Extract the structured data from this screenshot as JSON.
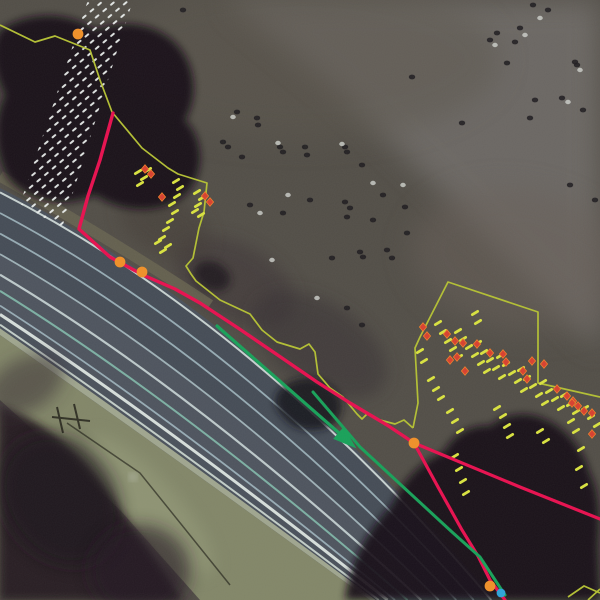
{
  "canvas": {
    "w": 600,
    "h": 600
  },
  "colors": {
    "field_base": "#524e47",
    "field_light": "#5b564e",
    "upper_right_gray": "#6e6a66",
    "mid_shadow": "#3a3134",
    "tree_dark": "#131116",
    "vegetation_dark": "#281e24",
    "road_asphalt": "#4a515b",
    "road_stripe": "#9bb0b8",
    "road_edge_white": "#dde6e2",
    "shoulder": "#828668",
    "hatch_white": "#e9edeb",
    "boundary_yellow": "#b3bf33",
    "dash_yellow": "#d9e23f",
    "route_red": "#e8104f",
    "direction_green": "#18a159",
    "marker_red": "#d8402f",
    "marker_orange": "#ef7f2a",
    "waypoint_orange": "#f09028",
    "waypoint_blue": "#2ea4d9",
    "shadow_dark": "#17150f",
    "speckle_dark": "#1d1b1e",
    "speckle_light": "#cfd2cd"
  },
  "background": {
    "regions": [
      {
        "name": "upper-right-gray-field",
        "type": "polygon",
        "points": [
          [
            225,
            0
          ],
          [
            600,
            0
          ],
          [
            600,
            350
          ],
          [
            455,
            205
          ],
          [
            335,
            90
          ]
        ],
        "fill": "#6e6a66",
        "opacity": 0.92,
        "blur": "b14"
      },
      {
        "name": "top-field-light-patch",
        "type": "ellipse",
        "cx": 300,
        "cy": 60,
        "rx": 200,
        "ry": 80,
        "rot": 0,
        "fill": "#5b564e",
        "opacity": 0.5,
        "blur": "b14"
      },
      {
        "name": "right-field-patch",
        "type": "ellipse",
        "cx": 520,
        "cy": 260,
        "rx": 110,
        "ry": 70,
        "rot": 10,
        "fill": "#675f58",
        "opacity": 0.5,
        "blur": "b14"
      },
      {
        "name": "mid-shadow-1",
        "type": "ellipse",
        "cx": 235,
        "cy": 282,
        "rx": 65,
        "ry": 38,
        "rot": 28,
        "fill": "#3b3134",
        "opacity": 0.5,
        "blur": "b8"
      },
      {
        "name": "mid-shadow-2",
        "type": "ellipse",
        "cx": 320,
        "cy": 345,
        "rx": 75,
        "ry": 42,
        "rot": 33,
        "fill": "#362d31",
        "opacity": 0.5,
        "blur": "b8"
      },
      {
        "name": "mid-shadow-3",
        "type": "ellipse",
        "cx": 165,
        "cy": 225,
        "rx": 50,
        "ry": 30,
        "rot": 30,
        "fill": "#433a36",
        "opacity": 0.45,
        "blur": "b8"
      }
    ]
  },
  "trees": [
    {
      "name": "tree-canopy-top-left",
      "d": "M0,30 C30,10 70,12 95,30 C120,20 150,22 172,40 C195,60 200,95 185,120 C205,140 205,175 185,195 C160,215 120,212 95,195 C60,210 25,200 8,178 C-5,155 -8,120 5,95 C-8,70 -10,45 0,30 Z",
      "fill": "#131116",
      "opacity": 0.92,
      "blur": "b4"
    },
    {
      "name": "tree-blob-left-mid",
      "type": "ellipse",
      "cx": 212,
      "cy": 276,
      "rx": 19,
      "ry": 14,
      "rot": 25,
      "fill": "#1a171b",
      "opacity": 0.8,
      "blur": "b4"
    },
    {
      "name": "tree-blob-center-road",
      "d": "M278,392 C288,378 312,374 326,384 C342,392 346,410 336,422 C322,434 296,432 286,420 C276,410 272,402 278,392 Z",
      "fill": "#16141a",
      "opacity": 0.85,
      "blur": "b4"
    },
    {
      "name": "tree-canopy-bottom-right",
      "d": "M345,600 C350,560 368,530 392,505 C402,482 420,462 444,452 C452,436 470,424 490,426 C504,414 528,410 546,420 C566,428 584,450 590,474 C600,492 600,520 598,545 L600,600 Z",
      "fill": "#131116",
      "opacity": 0.92,
      "blur": "b4"
    },
    {
      "name": "vegetation-bottom-left",
      "d": "M0,405 C40,420 80,448 120,510 C150,552 170,580 182,600 L0,600 Z",
      "fill": "#281e24",
      "opacity": 0.95,
      "blur": "b4"
    },
    {
      "name": "vegetation-inner-1",
      "type": "ellipse",
      "cx": 60,
      "cy": 500,
      "rx": 55,
      "ry": 70,
      "rot": -35,
      "fill": "#1c141b",
      "opacity": 0.7,
      "blur": "b8"
    },
    {
      "name": "vegetation-inner-2",
      "type": "ellipse",
      "cx": 140,
      "cy": 570,
      "rx": 50,
      "ry": 45,
      "rot": 0,
      "fill": "#201820",
      "opacity": 0.6,
      "blur": "b8"
    },
    {
      "name": "vegetation-edge-patch",
      "type": "ellipse",
      "cx": 25,
      "cy": 385,
      "rx": 42,
      "ry": 26,
      "rot": -30,
      "fill": "#352a31",
      "opacity": 0.5,
      "blur": "b8"
    }
  ],
  "road": {
    "ne_edge": [
      [
        0,
        188
      ],
      [
        260,
        320
      ],
      [
        495,
        600
      ]
    ],
    "sw_edge": [
      [
        0,
        335
      ],
      [
        150,
        440
      ],
      [
        370,
        600
      ]
    ],
    "surface_fill": "#4a515b",
    "bands": [
      {
        "f1": 0.03,
        "f2": 0.45,
        "c": "#40474f",
        "o": 0.45
      },
      {
        "f1": 0.45,
        "f2": 0.86,
        "c": "#545b64",
        "o": 0.4
      },
      {
        "f1": 0.955,
        "f2": 1.0,
        "c": "#b5bb9c",
        "o": 0.8
      }
    ],
    "stripes": [
      {
        "f": 0.03,
        "c": "#cdd8d6",
        "w": 2.0
      },
      {
        "f": 0.17,
        "c": "#9bb0b8",
        "w": 1.8
      },
      {
        "f": 0.31,
        "c": "#9bb0b8",
        "w": 1.8
      },
      {
        "f": 0.45,
        "c": "#a3b6bc",
        "w": 1.8
      },
      {
        "f": 0.59,
        "c": "#c3d0d0",
        "w": 2.2
      },
      {
        "f": 0.7,
        "c": "#7fb5a6",
        "w": 2.0
      },
      {
        "f": 0.8,
        "c": "#9bb0b8",
        "w": 1.8
      },
      {
        "f": 0.86,
        "c": "#dde6e2",
        "w": 3.0
      },
      {
        "f": 0.93,
        "c": "#c8d4ce",
        "w": 2.0
      }
    ],
    "shoulder_outer": [
      [
        200,
        600
      ],
      [
        120,
        510
      ],
      [
        0,
        400
      ]
    ],
    "shoulder_fill": "#828668",
    "shoulder_streak": {
      "cx": 150,
      "cy": 505,
      "rx": 90,
      "ry": 26,
      "rot": 48,
      "fill": "#9aa07e",
      "opacity": 0.5
    },
    "ne_grass_strip": {
      "quad": [
        [
          0,
          176
        ],
        [
          120,
          245
        ],
        [
          210,
          305
        ]
      ],
      "c": "#6b6752",
      "w": 11,
      "o": 0.75
    },
    "road_mark": [
      133,
      477
    ]
  },
  "pole_shadow": {
    "bars": [
      [
        57,
        407,
        63,
        433
      ],
      [
        74,
        404,
        80,
        429
      ]
    ],
    "cross": [
      52,
      417,
      90,
      421
    ],
    "long_line": [
      [
        67,
        423
      ],
      [
        140,
        473
      ],
      [
        230,
        585
      ]
    ],
    "color": "#17150f"
  },
  "hatch_band": {
    "points": [
      [
        88,
        0
      ],
      [
        133,
        0
      ],
      [
        62,
        228
      ],
      [
        20,
        204
      ]
    ],
    "dash": {
      "w": 5.5,
      "h": 2.0,
      "cell_w": 10,
      "cell_h": 8,
      "angle": -40,
      "color": "#e9edeb",
      "opacity": 0.95
    }
  },
  "annotations": {
    "yellow_boundary_left": [
      [
        0,
        25
      ],
      [
        35,
        42
      ],
      [
        55,
        36
      ],
      [
        90,
        50
      ],
      [
        100,
        80
      ],
      [
        112,
        112
      ],
      [
        142,
        148
      ],
      [
        168,
        168
      ],
      [
        178,
        174
      ],
      [
        207,
        183
      ],
      [
        204,
        212
      ],
      [
        199,
        228
      ],
      [
        193,
        258
      ],
      [
        186,
        266
      ],
      [
        191,
        274
      ],
      [
        196,
        281
      ],
      [
        220,
        300
      ],
      [
        250,
        314
      ],
      [
        262,
        330
      ],
      [
        277,
        342
      ],
      [
        300,
        349
      ],
      [
        309,
        344
      ],
      [
        315,
        352
      ],
      [
        318,
        374
      ],
      [
        330,
        388
      ],
      [
        343,
        397
      ],
      [
        357,
        414
      ],
      [
        362,
        419
      ],
      [
        368,
        413
      ],
      [
        380,
        420
      ],
      [
        395,
        424
      ],
      [
        404,
        420
      ],
      [
        413,
        428
      ]
    ],
    "yellow_boundary_right": [
      [
        413,
        428
      ],
      [
        418,
        403
      ],
      [
        415,
        348
      ],
      [
        420,
        337
      ],
      [
        448,
        282
      ],
      [
        538,
        312
      ],
      [
        538,
        383
      ],
      [
        600,
        397
      ]
    ],
    "yellow_corner_segments": [
      [
        [
          568,
          597
        ],
        [
          584,
          586
        ],
        [
          600,
          593
        ]
      ],
      [
        [
          588,
          600
        ],
        [
          600,
          589
        ]
      ]
    ],
    "red_route_main": [
      [
        113,
        113
      ],
      [
        100,
        160
      ],
      [
        88,
        196
      ],
      [
        79,
        229
      ],
      [
        110,
        257
      ],
      [
        143,
        275
      ],
      [
        175,
        289
      ],
      [
        200,
        303
      ],
      [
        238,
        328
      ],
      [
        282,
        358
      ],
      [
        317,
        382
      ],
      [
        350,
        403
      ],
      [
        387,
        425
      ],
      [
        414,
        443
      ]
    ],
    "red_route_branch_right": [
      [
        414,
        443
      ],
      [
        520,
        487
      ],
      [
        600,
        519
      ]
    ],
    "red_route_branch_road": [
      [
        414,
        443
      ],
      [
        438,
        487
      ],
      [
        462,
        530
      ],
      [
        478,
        556
      ],
      [
        490,
        580
      ],
      [
        505,
        600
      ]
    ],
    "green_arrow_line": [
      [
        217,
        326
      ],
      [
        347,
        440
      ]
    ],
    "green_arrow_tip": {
      "x": 349,
      "y": 442,
      "angle": 41
    },
    "green_line_2": [
      [
        313,
        392
      ],
      [
        360,
        447
      ],
      [
        400,
        484
      ],
      [
        452,
        532
      ],
      [
        480,
        557
      ],
      [
        505,
        595
      ]
    ],
    "dashes_left": [
      [
        138,
        172
      ],
      [
        144,
        178
      ],
      [
        140,
        184
      ],
      [
        148,
        170
      ],
      [
        176,
        181
      ],
      [
        180,
        188
      ],
      [
        177,
        196
      ],
      [
        172,
        204
      ],
      [
        175,
        212
      ],
      [
        170,
        221
      ],
      [
        166,
        229
      ],
      [
        162,
        238
      ],
      [
        168,
        246
      ],
      [
        158,
        242
      ],
      [
        163,
        251
      ],
      [
        197,
        192
      ],
      [
        202,
        198
      ],
      [
        198,
        205
      ],
      [
        195,
        211
      ],
      [
        201,
        215
      ]
    ],
    "dashes_right": [
      [
        475,
        313
      ],
      [
        478,
        322
      ],
      [
        438,
        323
      ],
      [
        443,
        332
      ],
      [
        448,
        341
      ],
      [
        453,
        349
      ],
      [
        459,
        357
      ],
      [
        458,
        331
      ],
      [
        463,
        339
      ],
      [
        469,
        347
      ],
      [
        475,
        355
      ],
      [
        481,
        363
      ],
      [
        487,
        371
      ],
      [
        478,
        343
      ],
      [
        484,
        352
      ],
      [
        490,
        360
      ],
      [
        496,
        368
      ],
      [
        502,
        377
      ],
      [
        500,
        356
      ],
      [
        506,
        364
      ],
      [
        512,
        373
      ],
      [
        518,
        381
      ],
      [
        524,
        390
      ],
      [
        521,
        369
      ],
      [
        527,
        378
      ],
      [
        533,
        386
      ],
      [
        539,
        395
      ],
      [
        545,
        403
      ],
      [
        543,
        382
      ],
      [
        549,
        391
      ],
      [
        555,
        399
      ],
      [
        561,
        408
      ],
      [
        564,
        395
      ],
      [
        570,
        404
      ],
      [
        576,
        412
      ],
      [
        585,
        408
      ],
      [
        591,
        417
      ],
      [
        597,
        425
      ],
      [
        420,
        351
      ],
      [
        424,
        361
      ],
      [
        431,
        379
      ],
      [
        436,
        389
      ],
      [
        441,
        398
      ],
      [
        450,
        411
      ],
      [
        455,
        421
      ],
      [
        460,
        431
      ],
      [
        497,
        408
      ],
      [
        503,
        416
      ],
      [
        507,
        426
      ],
      [
        510,
        436
      ],
      [
        455,
        456
      ],
      [
        459,
        469
      ],
      [
        463,
        481
      ],
      [
        466,
        493
      ],
      [
        581,
        449
      ],
      [
        579,
        468
      ],
      [
        584,
        486
      ],
      [
        571,
        421
      ],
      [
        576,
        431
      ],
      [
        540,
        431
      ],
      [
        546,
        441
      ]
    ],
    "markers_left": [
      [
        145,
        169
      ],
      [
        151,
        174
      ],
      [
        162,
        197
      ],
      [
        205,
        196
      ],
      [
        210,
        202
      ]
    ],
    "markers_right": [
      [
        423,
        327
      ],
      [
        427,
        336
      ],
      [
        447,
        334
      ],
      [
        455,
        341
      ],
      [
        463,
        343
      ],
      [
        450,
        360
      ],
      [
        457,
        357
      ],
      [
        465,
        371
      ],
      [
        477,
        344
      ],
      [
        490,
        353
      ],
      [
        503,
        354
      ],
      [
        506,
        362
      ],
      [
        523,
        371
      ],
      [
        527,
        379
      ],
      [
        532,
        361
      ],
      [
        544,
        364
      ],
      [
        557,
        389
      ],
      [
        567,
        396
      ],
      [
        573,
        401
      ],
      [
        578,
        406
      ],
      [
        584,
        411
      ],
      [
        592,
        413
      ],
      [
        572,
        403
      ],
      [
        592,
        434
      ]
    ],
    "orange_points": [
      [
        78,
        34
      ],
      [
        120,
        262
      ],
      [
        142,
        272
      ],
      [
        414,
        443
      ],
      [
        490,
        586
      ]
    ],
    "blue_point": [
      501,
      593
    ]
  },
  "speckles": {
    "dark": [
      [
        183,
        10
      ],
      [
        237,
        112
      ],
      [
        257,
        118
      ],
      [
        258,
        125
      ],
      [
        223,
        142
      ],
      [
        228,
        147
      ],
      [
        242,
        157
      ],
      [
        280,
        147
      ],
      [
        283,
        152
      ],
      [
        305,
        147
      ],
      [
        307,
        155
      ],
      [
        345,
        147
      ],
      [
        347,
        152
      ],
      [
        362,
        165
      ],
      [
        250,
        205
      ],
      [
        283,
        213
      ],
      [
        310,
        200
      ],
      [
        345,
        202
      ],
      [
        350,
        208
      ],
      [
        383,
        195
      ],
      [
        405,
        207
      ],
      [
        347,
        217
      ],
      [
        373,
        220
      ],
      [
        407,
        233
      ],
      [
        360,
        252
      ],
      [
        387,
        250
      ],
      [
        363,
        257
      ],
      [
        392,
        258
      ],
      [
        332,
        258
      ],
      [
        347,
        308
      ],
      [
        362,
        325
      ],
      [
        490,
        40
      ],
      [
        497,
        33
      ],
      [
        520,
        28
      ],
      [
        515,
        42
      ],
      [
        533,
        5
      ],
      [
        548,
        10
      ],
      [
        575,
        62
      ],
      [
        577,
        65
      ],
      [
        535,
        100
      ],
      [
        562,
        98
      ],
      [
        583,
        110
      ],
      [
        507,
        63
      ],
      [
        412,
        77
      ],
      [
        462,
        123
      ],
      [
        530,
        118
      ],
      [
        595,
        200
      ],
      [
        570,
        185
      ]
    ],
    "light": [
      [
        233,
        117
      ],
      [
        278,
        143
      ],
      [
        342,
        144
      ],
      [
        288,
        195
      ],
      [
        260,
        213
      ],
      [
        373,
        183
      ],
      [
        272,
        260
      ],
      [
        317,
        298
      ],
      [
        403,
        185
      ],
      [
        495,
        45
      ],
      [
        540,
        18
      ],
      [
        580,
        70
      ],
      [
        525,
        35
      ],
      [
        568,
        102
      ]
    ]
  }
}
